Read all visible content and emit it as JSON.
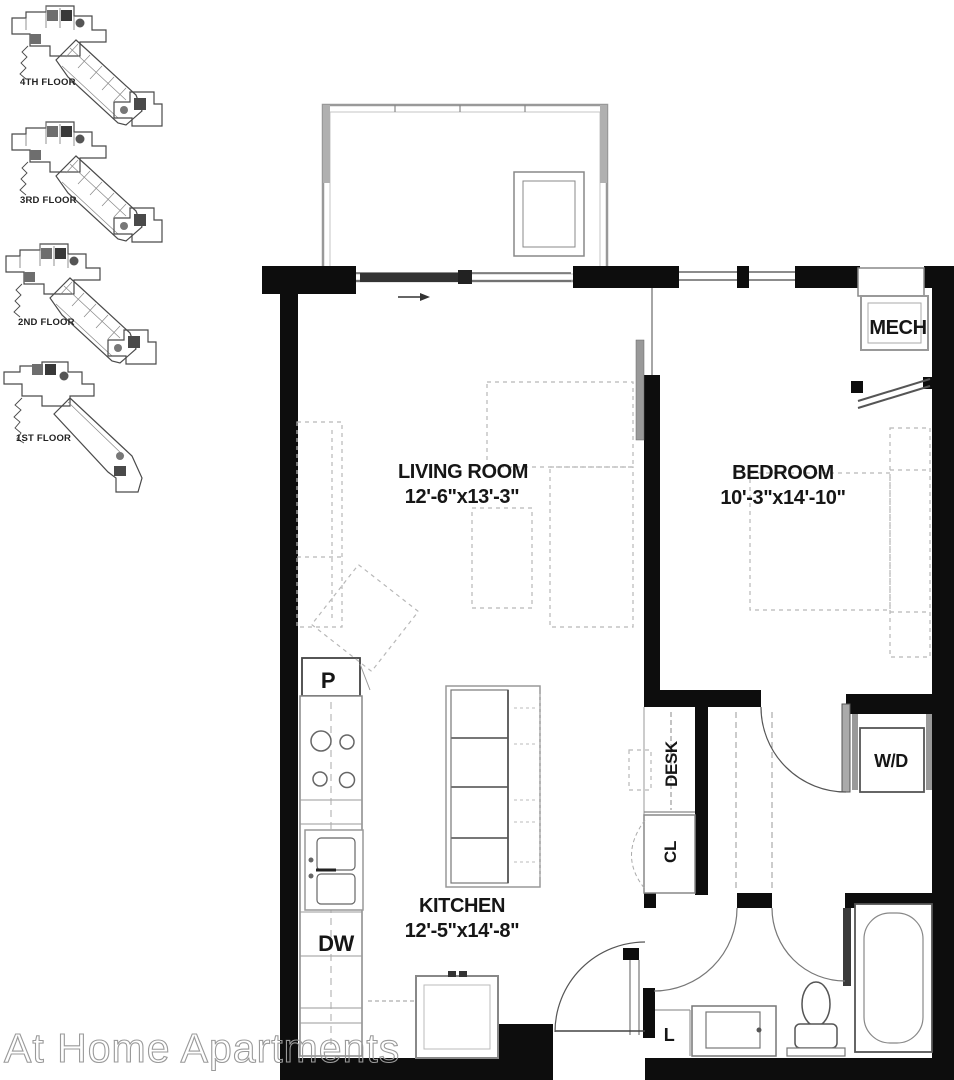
{
  "watermark": "At Home Apartments",
  "floor_plans": {
    "floors": [
      {
        "label": "4TH FLOOR"
      },
      {
        "label": "3RD FLOOR"
      },
      {
        "label": "2ND FLOOR"
      },
      {
        "label": "1ST FLOOR"
      }
    ]
  },
  "unit": {
    "living_room": {
      "name": "LIVING ROOM",
      "dims": "12'-6\"x13'-3\""
    },
    "bedroom": {
      "name": "BEDROOM",
      "dims": "10'-3\"x14'-10\""
    },
    "kitchen": {
      "name": "KITCHEN",
      "dims": "12'-5\"x14'-8\""
    },
    "labels": {
      "mech": "MECH",
      "desk": "DESK",
      "closet": "CL",
      "washer_dryer": "W/D",
      "pantry": "P",
      "dishwasher": "DW",
      "linen": "L"
    }
  },
  "colors": {
    "wall": "#0d0d0d",
    "line": "#666666",
    "dashed_furniture": "#b8b8b8",
    "watermark_outline": "#9a9a9a"
  }
}
